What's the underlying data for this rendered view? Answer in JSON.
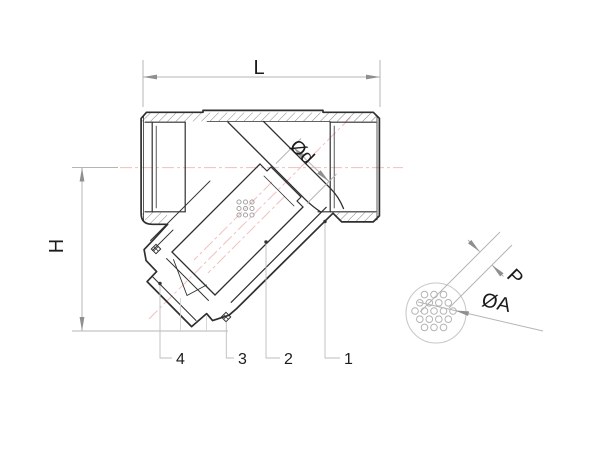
{
  "drawing": {
    "type_label": "y-strainer-sectional-drawing",
    "dimension_labels": {
      "length": "L",
      "height": "H",
      "branch_bore": "Ød",
      "hole_pitch": "P",
      "hole_diameter": "ØA"
    },
    "parts": [
      {
        "number": "4"
      },
      {
        "number": "3"
      },
      {
        "number": "2"
      },
      {
        "number": "1"
      }
    ],
    "colors": {
      "outline": "#2f2f2f",
      "dimension_line": "#b5b5b5",
      "leader_line": "#bdbdbd",
      "centerline": "#f0c1be",
      "background": "#ffffff"
    }
  }
}
